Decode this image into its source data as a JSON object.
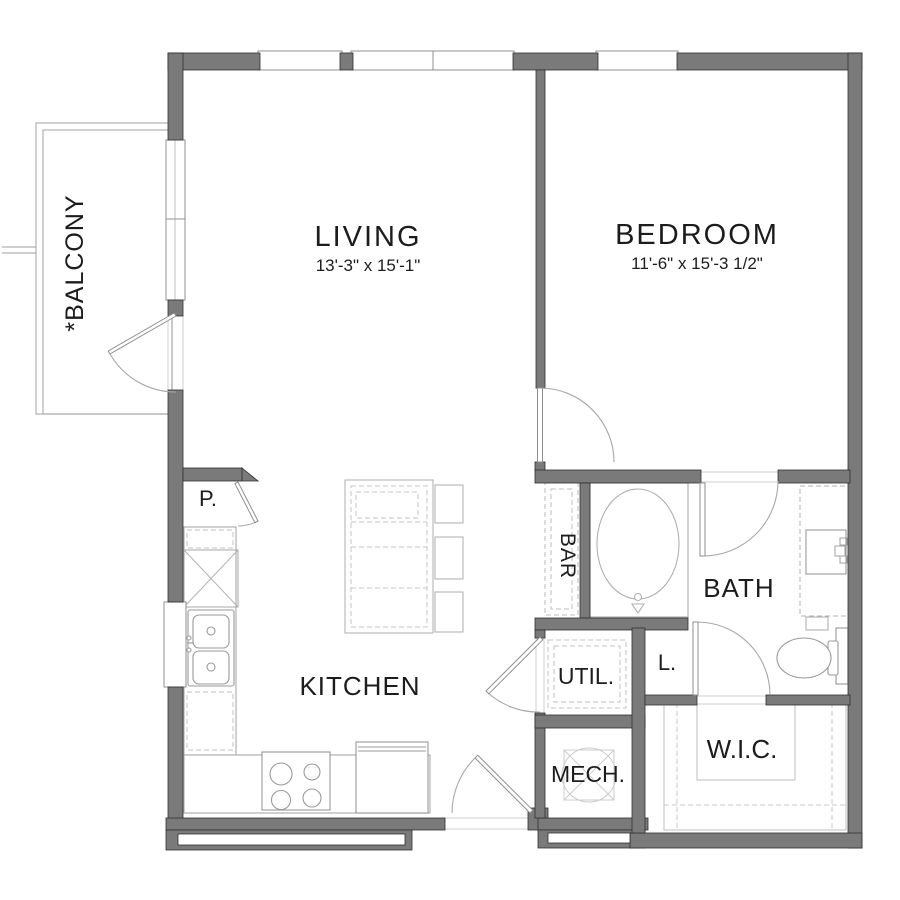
{
  "plan": {
    "title": "One-bedroom apartment floor plan",
    "rooms": {
      "living": {
        "label": "LIVING",
        "dimensions": "13'-3\" x 15'-1\""
      },
      "bedroom": {
        "label": "BEDROOM",
        "dimensions": "11'-6\" x 15'-3 1/2\""
      },
      "balcony": {
        "label": "*BALCONY"
      },
      "kitchen": {
        "label": "KITCHEN"
      },
      "bath": {
        "label": "BATH"
      },
      "bar": {
        "label": "BAR"
      },
      "pantry": {
        "label": "P."
      },
      "utility": {
        "label": "UTIL."
      },
      "linen": {
        "label": "L."
      },
      "mechanical": {
        "label": "MECH."
      },
      "walk_in_closet": {
        "label": "W.I.C."
      }
    },
    "colors": {
      "wall": "#7a7a7a",
      "wall_outline": "#2f2f2f",
      "fixture_line": "#a8a8a8",
      "light_line": "#bdbdbd",
      "background": "#ffffff",
      "text": "#1c1c1c"
    }
  }
}
